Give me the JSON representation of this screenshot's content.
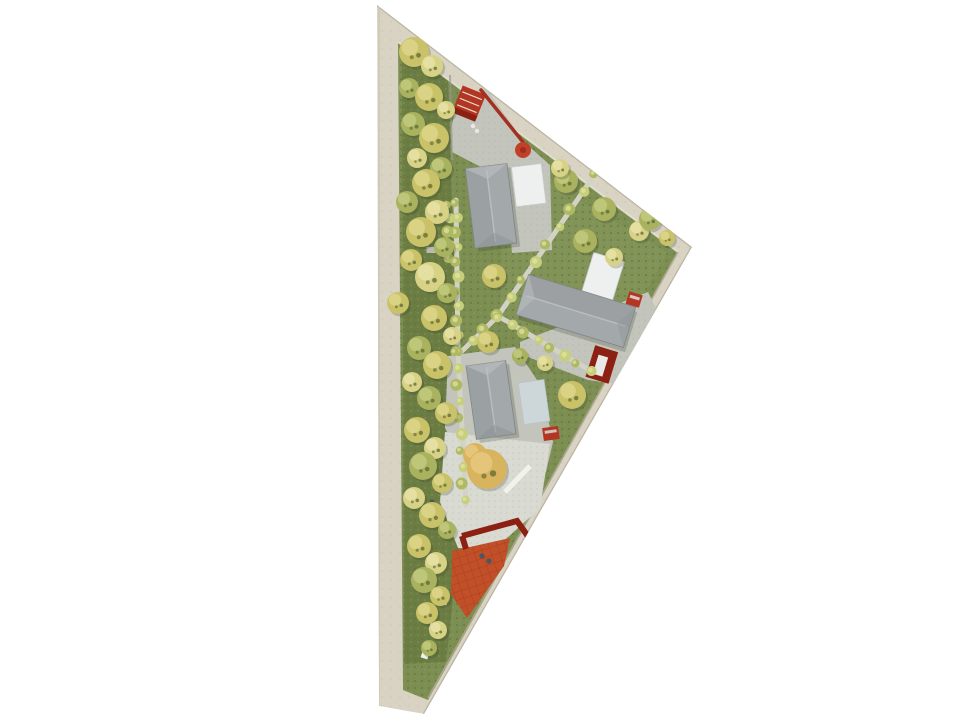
{
  "page": {
    "background": "#ffffff"
  },
  "palette": {
    "sidewalk": "#d8d3c3",
    "sidewalk_dot": "#c8c2b0",
    "site_edge": "#b8b19e",
    "side_line": "#cdc7b6",
    "lawn": "#7c8e52",
    "lawn_dark": "#66793f",
    "lawn_tint": "#87975d",
    "grass_dot_dark": "#5d703b",
    "grass_dot_light": "#90a05f",
    "path": "#d2d2c5",
    "paving": "#c3c5bc",
    "paving_dot": "#9fa29a",
    "plaza_light": "#d9dbd3",
    "wall_gray": "#9a9a90",
    "roof": "#a3a8aa",
    "roof_dark": "#8e9395",
    "roof_light": "#bcc0c1",
    "roof_edge": "#7e8486",
    "annex_white": "#eef0ef",
    "annex_edge": "#c6c9c6",
    "annex_blue": "#cdd6d9",
    "annex_blue_edge": "#b9c2c5",
    "red": "#b23622",
    "red_bright": "#c0402a",
    "red_hedge": "#a33020",
    "dark_red": "#8c2012",
    "terracotta": "#c14f28",
    "terracotta_line": "#a23c1c",
    "white_detail": "#f2f2ec",
    "car_white": "#e8e8e6",
    "glass": "#dfe3e2",
    "stripe": "#e6e3da",
    "fence": "#e9e6d9",
    "fence_dark": "#b3ac99",
    "stone": "#b9bbb3",
    "people_dark": "#4b5563",
    "people_light": "#e8e8e4",
    "shadow": "#2f3524",
    "tree": {
      "y": "#c9c268",
      "l": "#d8d287",
      "g": "#a9b25e",
      "o": "#d9b45e"
    },
    "tree_hi": {
      "y": "#ddd68b",
      "l": "#e7e3a6",
      "g": "#c2ca7e",
      "o": "#e6c87e"
    },
    "tree_dot": "#57622f",
    "shrub_a": "#c6cf7c",
    "shrub_b": "#aeba63"
  },
  "trees": [
    [
      414,
      52,
      15,
      "y"
    ],
    [
      432,
      66,
      11,
      "l"
    ],
    [
      409,
      88,
      10,
      "g"
    ],
    [
      429,
      97,
      14,
      "y"
    ],
    [
      446,
      110,
      9,
      "l"
    ],
    [
      413,
      124,
      12,
      "g"
    ],
    [
      434,
      138,
      15,
      "y"
    ],
    [
      417,
      158,
      10,
      "l"
    ],
    [
      441,
      168,
      11,
      "g"
    ],
    [
      426,
      183,
      14,
      "y"
    ],
    [
      407,
      202,
      11,
      "g"
    ],
    [
      437,
      212,
      12,
      "l"
    ],
    [
      421,
      232,
      15,
      "y"
    ],
    [
      444,
      247,
      10,
      "g"
    ],
    [
      411,
      260,
      11,
      "y"
    ],
    [
      430,
      277,
      15,
      "l"
    ],
    [
      447,
      293,
      10,
      "g"
    ],
    [
      398,
      303,
      11,
      "y"
    ],
    [
      434,
      318,
      13,
      "y"
    ],
    [
      452,
      336,
      9,
      "l"
    ],
    [
      419,
      348,
      12,
      "g"
    ],
    [
      437,
      365,
      14,
      "y"
    ],
    [
      412,
      382,
      10,
      "l"
    ],
    [
      429,
      398,
      12,
      "g"
    ],
    [
      446,
      413,
      11,
      "y"
    ],
    [
      417,
      430,
      13,
      "y"
    ],
    [
      435,
      448,
      11,
      "l"
    ],
    [
      423,
      466,
      14,
      "g"
    ],
    [
      442,
      483,
      10,
      "y"
    ],
    [
      414,
      498,
      11,
      "l"
    ],
    [
      432,
      515,
      13,
      "y"
    ],
    [
      447,
      530,
      9,
      "g"
    ],
    [
      419,
      546,
      12,
      "y"
    ],
    [
      436,
      563,
      11,
      "l"
    ],
    [
      424,
      580,
      13,
      "g"
    ],
    [
      440,
      596,
      10,
      "y"
    ],
    [
      427,
      613,
      11,
      "y"
    ],
    [
      438,
      630,
      9,
      "l"
    ],
    [
      429,
      648,
      8,
      "g"
    ],
    [
      566,
      181,
      12,
      "g"
    ],
    [
      604,
      209,
      12,
      "g"
    ],
    [
      639,
      231,
      10,
      "l"
    ],
    [
      585,
      241,
      12,
      "g"
    ],
    [
      614,
      257,
      9,
      "l"
    ],
    [
      650,
      219,
      11,
      "g"
    ],
    [
      667,
      238,
      8,
      "y"
    ],
    [
      560,
      168,
      9,
      "l"
    ],
    [
      572,
      395,
      14,
      "y"
    ],
    [
      545,
      363,
      8,
      "l"
    ],
    [
      520,
      356,
      8,
      "g"
    ],
    [
      488,
      342,
      11,
      "y"
    ],
    [
      494,
      276,
      12,
      "y"
    ],
    [
      475,
      455,
      12,
      "o"
    ],
    [
      487,
      469,
      20,
      "o"
    ]
  ],
  "shrub_lines": [
    [
      456,
      203,
      458,
      350,
      11
    ],
    [
      595,
      174,
      498,
      315,
      9
    ],
    [
      498,
      317,
      590,
      371,
      8
    ],
    [
      460,
      352,
      496,
      318,
      4
    ],
    [
      456,
      352,
      464,
      500,
      10
    ],
    [
      448,
      205,
      450,
      258,
      5
    ]
  ],
  "pavers": [
    [
      444,
      601
    ],
    [
      433,
      627
    ],
    [
      425,
      655
    ]
  ],
  "stones": [
    [
      424,
      243
    ],
    [
      431,
      250
    ]
  ],
  "people": [
    [
      432,
      502
    ],
    [
      437,
      506
    ],
    [
      482,
      556
    ],
    [
      489,
      561
    ]
  ],
  "people_light": [
    [
      473,
      126
    ],
    [
      477,
      131
    ]
  ]
}
